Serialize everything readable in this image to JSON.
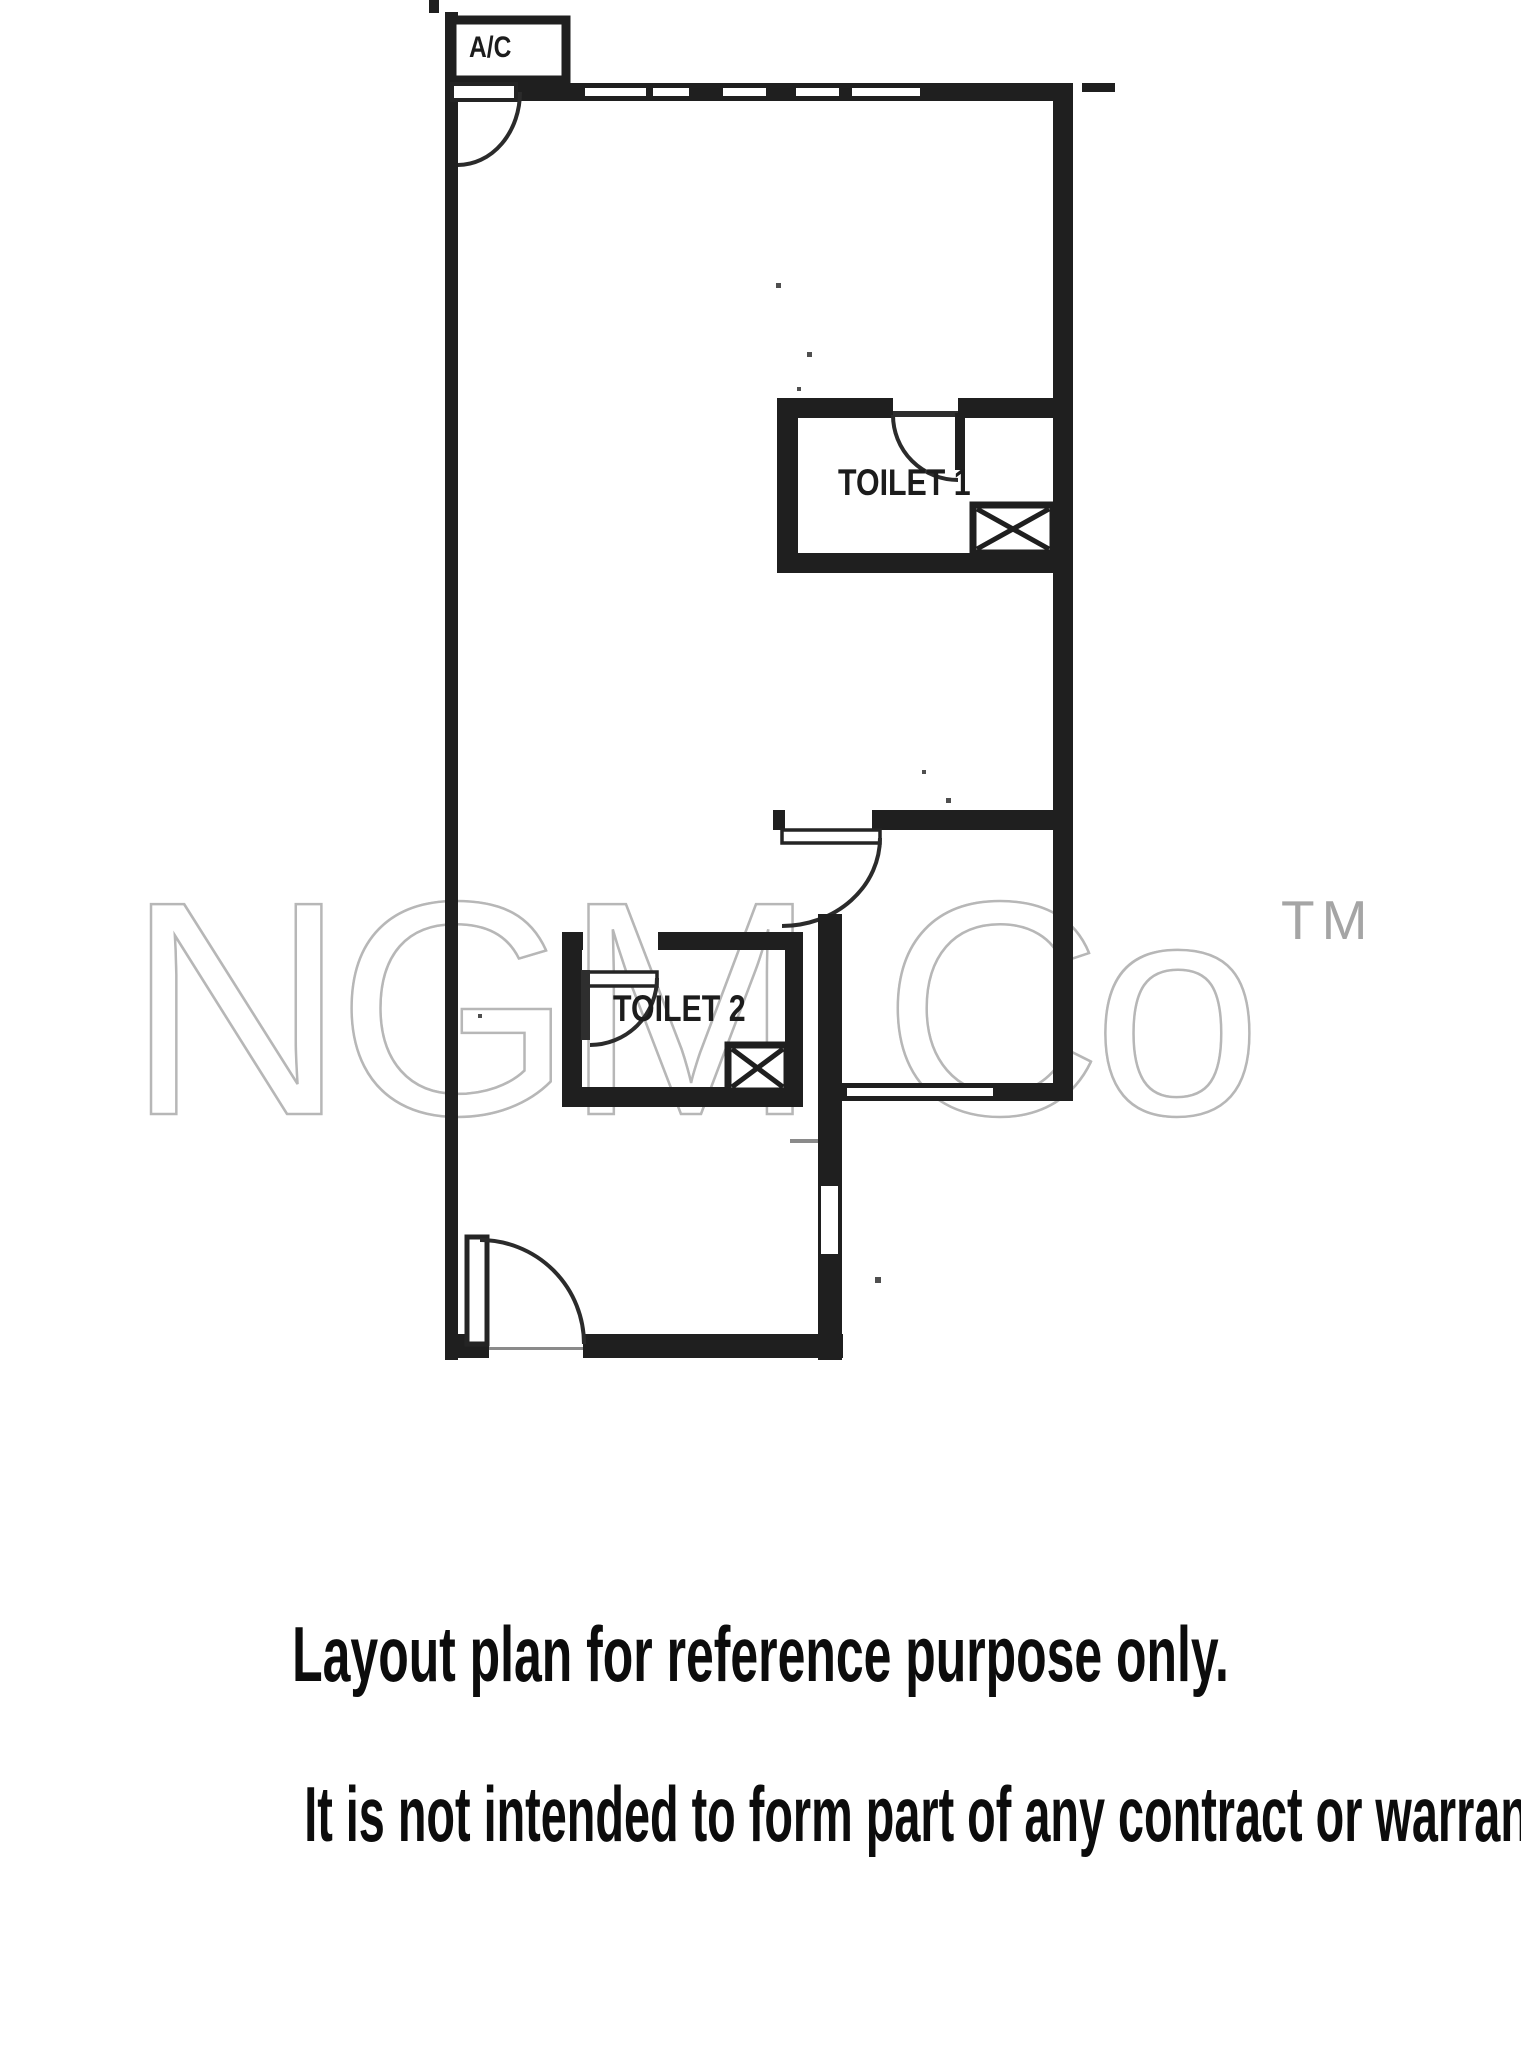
{
  "figure": {
    "type": "scanned floor plan",
    "labels": {
      "ac_unit": "A/C",
      "toilet1": "TOILET 1",
      "toilet2": "TOILET 2"
    },
    "colors": {
      "paper": "#ffffff",
      "wall": "#1f1f1f",
      "watermark": "#b7b7b7",
      "caption_text": "#0c0c0c"
    }
  },
  "watermark": {
    "text": "NGM Co",
    "tm": "TM"
  },
  "captions": {
    "line1": "Layout plan for reference purpose only.",
    "line2": "It is not intended to form part of any contract or warranty."
  }
}
